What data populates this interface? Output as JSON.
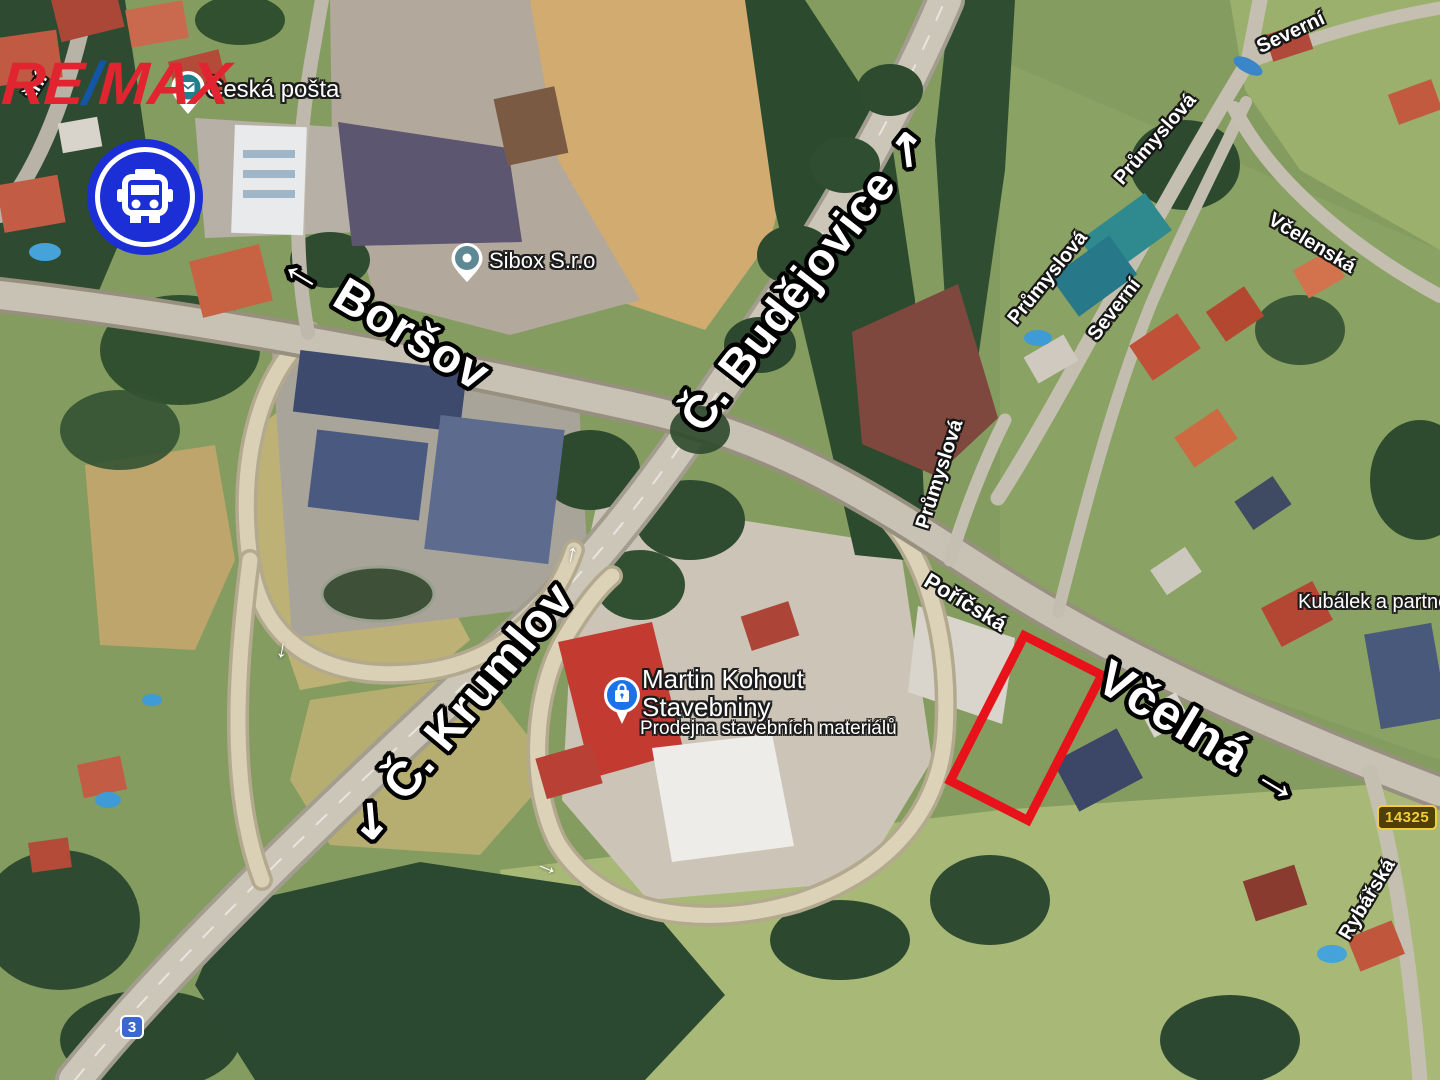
{
  "colors": {
    "remax_red": "#E1242F",
    "remax_blue": "#1455A4",
    "bus_blue": "#1C2FD6",
    "outline_red": "#E8121A",
    "badge3_bg": "#3B67CE",
    "badge14325_bg": "#514005",
    "bad14325_unused": "#000000",
    "badge14325_text": "#F2CF3A",
    "pin_teal": "#1F7F8C",
    "sibox_teal": "#5E8894",
    "kohout_blue": "#1A73E8"
  },
  "branding": {
    "re": "RE",
    "slash": "/",
    "max": "MAX"
  },
  "destinations": {
    "borsov": {
      "arrow": "←",
      "label": "Boršov"
    },
    "budejovice": {
      "label": "Č. Budějovice",
      "arrow": "↗"
    },
    "krumlov": {
      "arrow": "↙",
      "label": "Č. Krumlov"
    },
    "vcelna": {
      "label": "Včelná",
      "arrow": "→"
    }
  },
  "streets": {
    "fragment_zni": "žní",
    "prumyslova": "Průmyslová",
    "severni": "Severní",
    "vcelenska": "Včelenská",
    "poricska": "Poříčská",
    "rybarska": "Rybářská"
  },
  "pois": {
    "ceska_posta": {
      "name": "Česká pošta"
    },
    "sibox": {
      "name": "Sibox S.r.o"
    },
    "martin_kohout": {
      "name_line1": "Martin Kohout",
      "name_line2": "Stavebniny",
      "subtitle": "Prodejna stavebních materiálů"
    },
    "kubalek": {
      "name": "Kubálek a partne"
    }
  },
  "route_badges": {
    "national_road": "3",
    "regional_road": "14325"
  },
  "lane_arrows": {
    "up": "↑",
    "down": "↓",
    "right": "→"
  }
}
